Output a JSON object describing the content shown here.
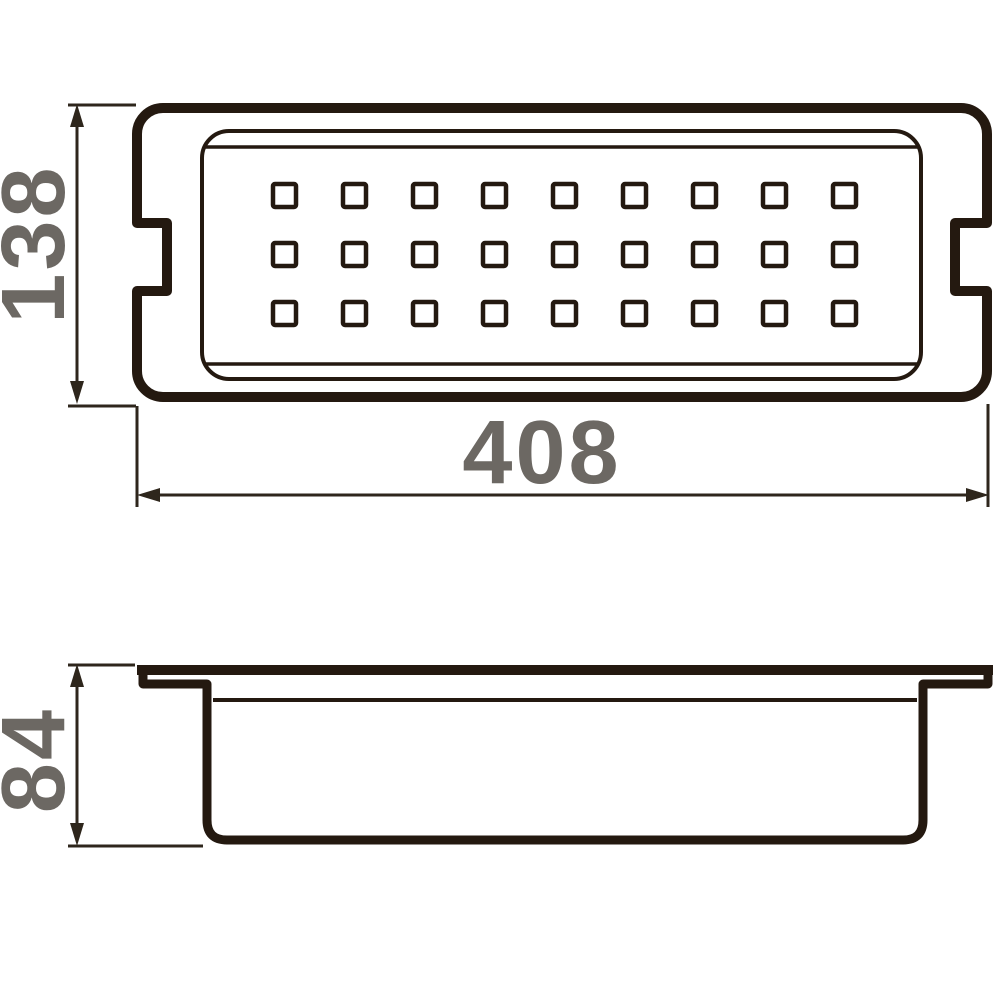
{
  "colors": {
    "outline": "#241910",
    "dimension": "#2e261c",
    "label": "#6c6863",
    "background": "#ffffff"
  },
  "top_view": {
    "width_dimension": "408",
    "height_dimension": "138",
    "perforation": {
      "rows": 3,
      "cols": 9
    }
  },
  "side_view": {
    "height_dimension": "84"
  }
}
